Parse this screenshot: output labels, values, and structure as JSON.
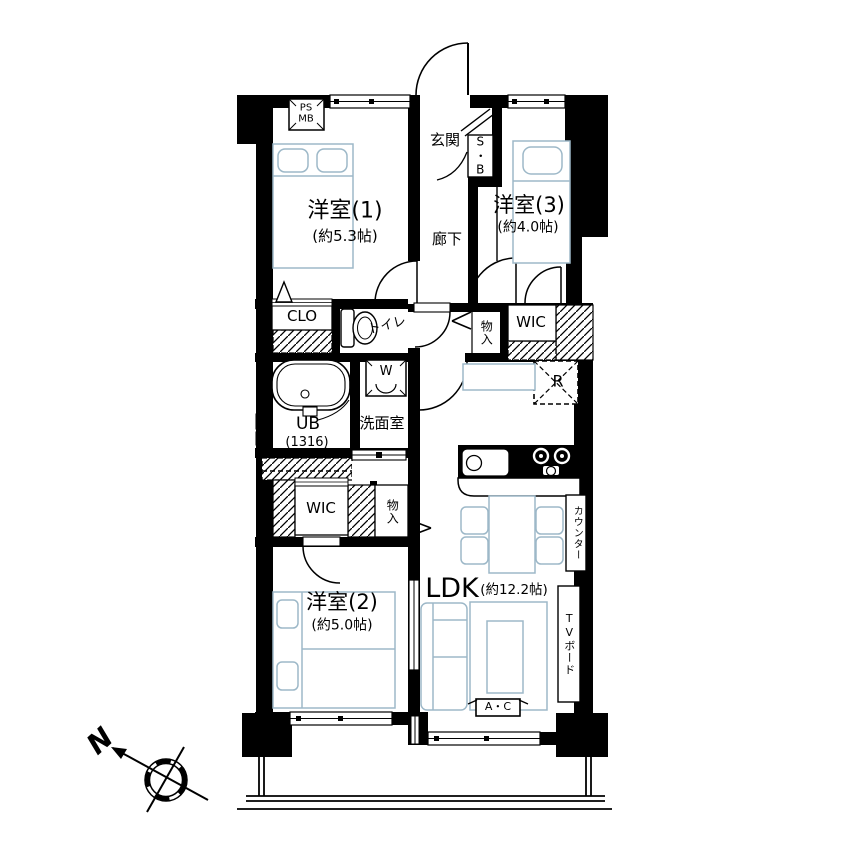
{
  "plan": {
    "rooms": {
      "room1": {
        "name": "洋室(1)",
        "size": "(約5.3帖)"
      },
      "room2": {
        "name": "洋室(2)",
        "size": "(約5.0帖)"
      },
      "room3": {
        "name": "洋室(3)",
        "size": "(約4.0帖)"
      },
      "ldk": {
        "name": "LDK",
        "size": "(約12.2帖)"
      },
      "entrance": "玄関",
      "hallway": "廊下",
      "washroom": "洗面室",
      "toilet": "トイレ",
      "unit_bath": {
        "name": "UB",
        "size": "(1316)"
      }
    },
    "storage": {
      "closet": "CLO",
      "wic_upper": "WIC",
      "wic_lower": "WIC",
      "storage_upper": "物入",
      "storage_lower": "物入",
      "shoe_box": "S・B",
      "pipe_meter": "PS\nMB"
    },
    "equipment": {
      "washer": "W",
      "fridge": "R",
      "counter": "カウンター",
      "tv_board": "TVボード",
      "ac": "A・C"
    },
    "compass": {
      "north": "N"
    },
    "colors": {
      "wall": "#000000",
      "furniture": "#9db8c8",
      "background": "#ffffff"
    }
  }
}
